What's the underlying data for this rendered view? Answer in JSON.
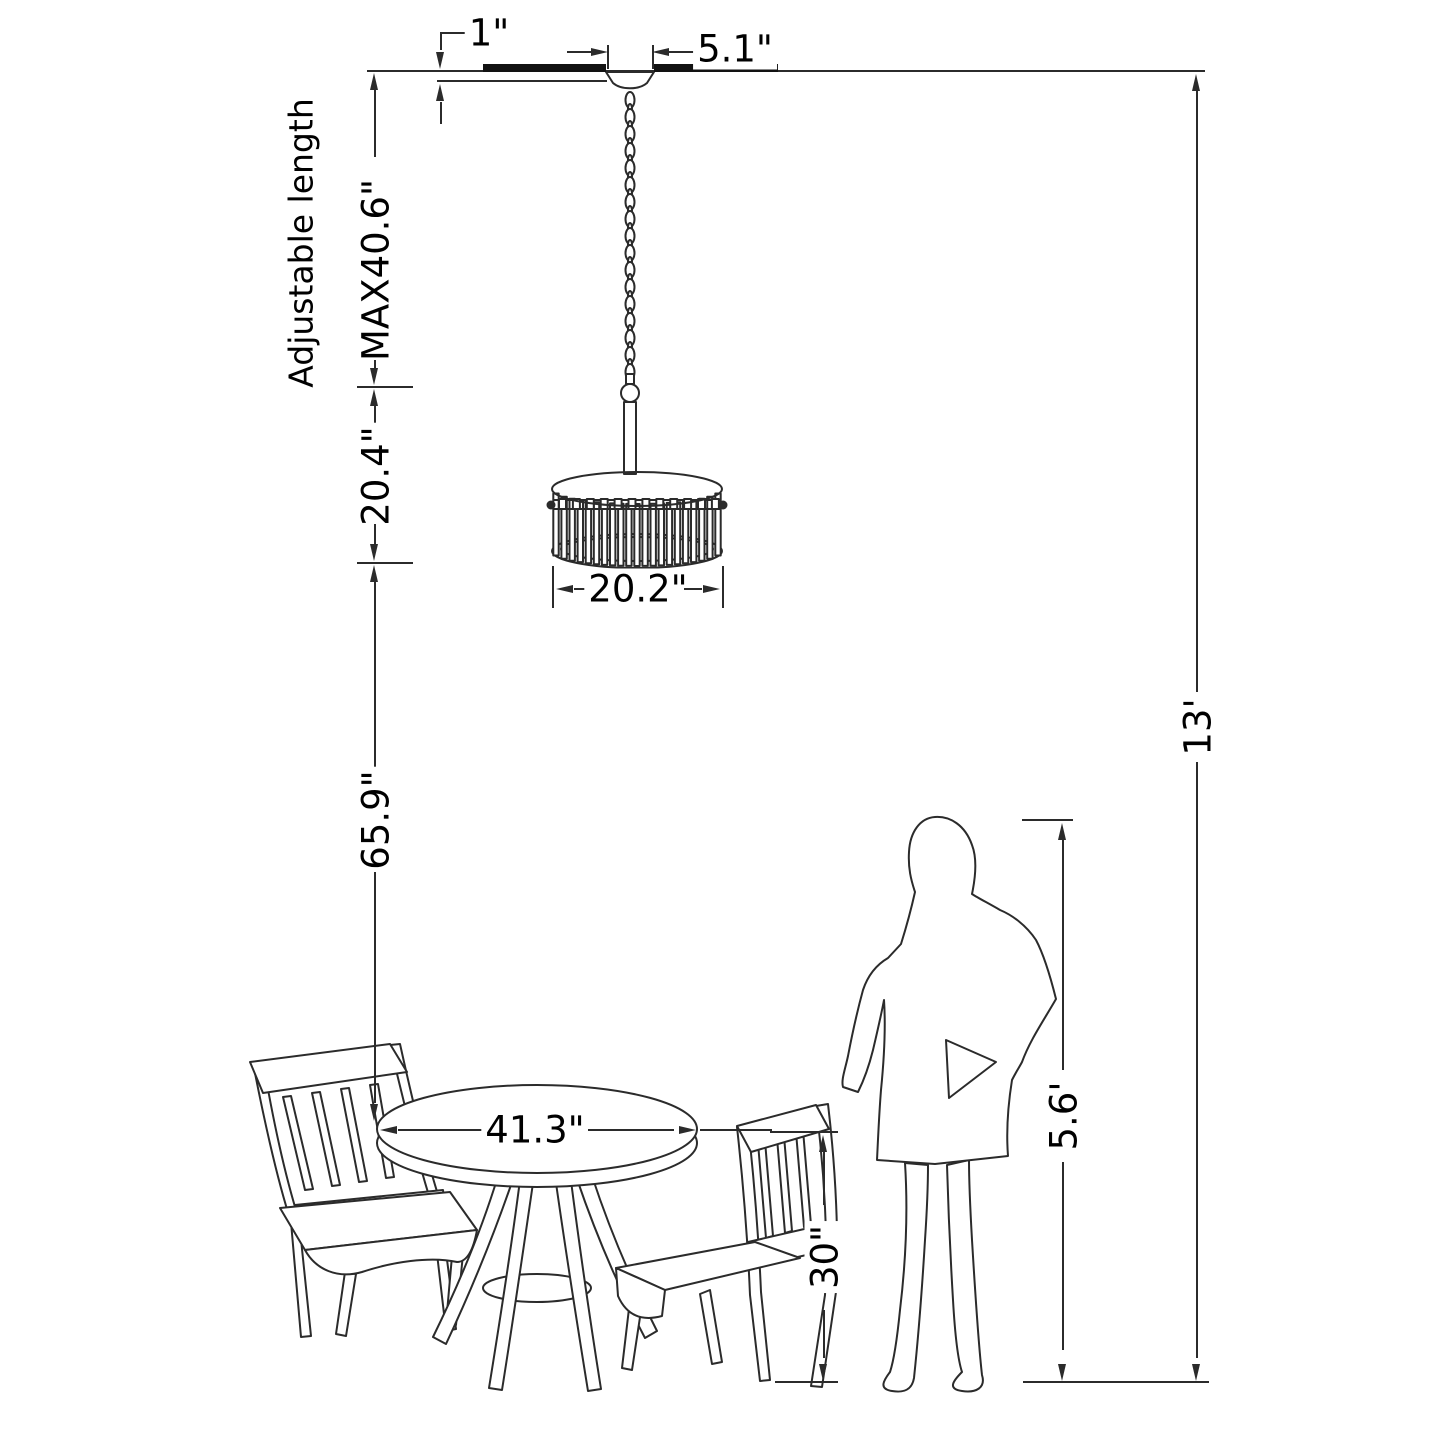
{
  "colors": {
    "background": "#ffffff",
    "line": "#2b2b2b",
    "text": "#000000"
  },
  "labels": {
    "canopy_height": "1\"",
    "canopy_width": "5.1\"",
    "adjustable_length": "Adjustable length",
    "max_length": "MAX40.6\"",
    "fixture_height": "20.4\"",
    "shade_width": "20.2\"",
    "hanging_clearance": "65.9\"",
    "table_width": "41.3\"",
    "chair_height": "30\"",
    "person_height": "5.6'",
    "ceiling_height": "13'"
  },
  "scene": {
    "objects": [
      "ceiling",
      "pendant-chandelier",
      "chain",
      "drum-shade",
      "dining-table",
      "side-chair-left",
      "side-chair-right",
      "woman-silhouette",
      "floor"
    ]
  }
}
